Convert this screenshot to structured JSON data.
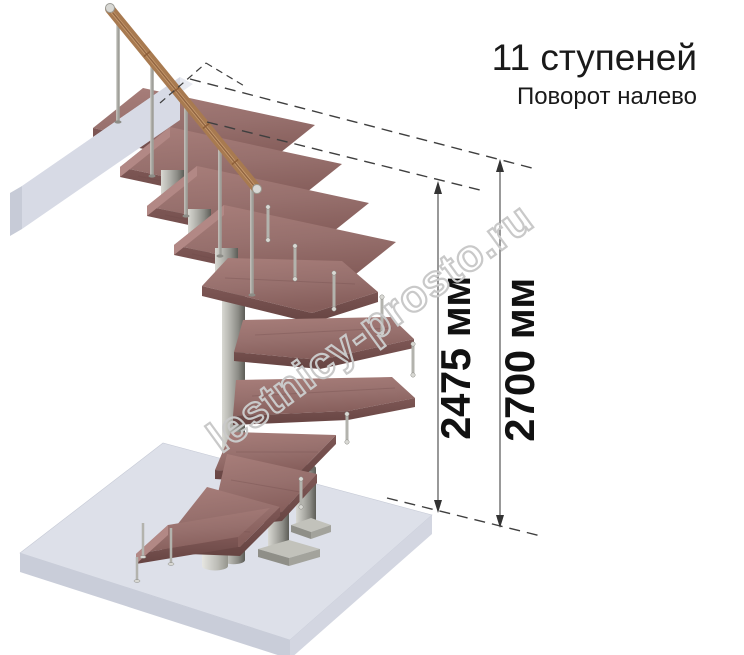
{
  "header": {
    "title": "11 ступеней",
    "subtitle": "Поворот налево"
  },
  "watermark": {
    "text": "lestnicy-prosto.ru",
    "color": "#c9c9c9"
  },
  "dimensions": {
    "inner": {
      "label": "2475 мм"
    },
    "outer": {
      "label": "2700 мм"
    }
  },
  "colors": {
    "text": "#1a1a1a",
    "dimension_text": "#111111",
    "annotation_line": "#3f3f3f",
    "wood": "#9b7370",
    "wood_edge": "#6f4b49",
    "metal": "#a8a8a2",
    "handrail": "#a87a50",
    "floor": "#dde0e9"
  }
}
